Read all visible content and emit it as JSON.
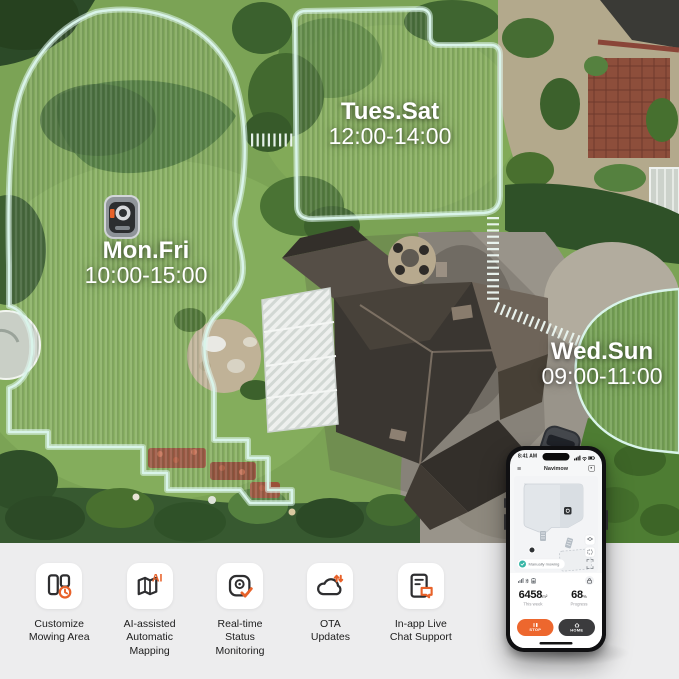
{
  "zones": [
    {
      "days": "Mon.Fri",
      "time": "10:00-15:00"
    },
    {
      "days": "Tues.Sat",
      "time": "12:00-14:00"
    },
    {
      "days": "Wed.Sun",
      "time": "09:00-11:00"
    }
  ],
  "phone": {
    "status_time": "8:41 AM",
    "app_title": "Navimow",
    "status_pill": "Manually mowing",
    "stats": {
      "area_value": "6458",
      "area_unit": "m²",
      "area_label": "This week",
      "progress_value": "68",
      "progress_unit": "%",
      "progress_label": "Progress"
    },
    "buttons": {
      "stop": "STOP",
      "home": "HOME"
    }
  },
  "features": [
    {
      "icon": "customize-area-icon",
      "label": "Customize\nMowing Area"
    },
    {
      "icon": "ai-mapping-icon",
      "label": "AI-assisted\nAutomatic\nMapping"
    },
    {
      "icon": "status-monitoring-icon",
      "label": "Real-time\nStatus\nMonitoring"
    },
    {
      "icon": "ota-updates-icon",
      "label": "OTA\nUpdates"
    },
    {
      "icon": "chat-support-icon",
      "label": "In-app Live\nChat Support"
    }
  ],
  "colors": {
    "accent_orange": "#ed672e",
    "zone_outline": "#d9f4ea",
    "band_bg": "#ededee",
    "home_button": "#3b3b3d",
    "teal_status": "#35b5a5"
  }
}
